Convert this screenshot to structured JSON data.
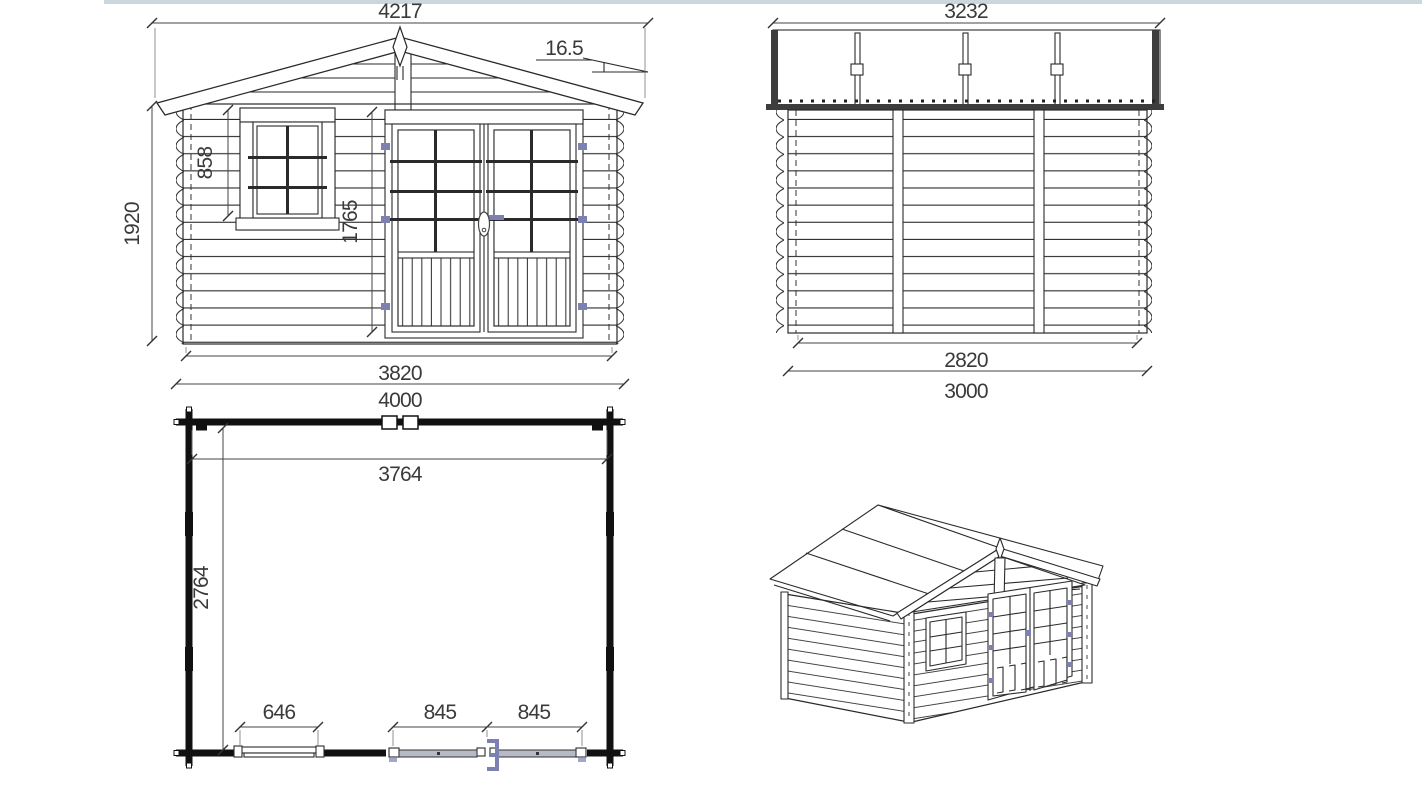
{
  "sheet": {
    "top_strip_color": "#ccd7dd",
    "background": "#ffffff"
  },
  "colors": {
    "line": "#2a2a2a",
    "accent": "#7c80b3",
    "door_slab_fill": "#b6bac5",
    "wall_dark": "#111111",
    "text": "#3a3a3a"
  },
  "views": {
    "front_elevation": {
      "label": "front elevation",
      "dims": {
        "roof_overall_width": "4217",
        "roof_pitch_deg": "16.5",
        "wall_height": "1920",
        "window_height": "858",
        "door_height": "1765",
        "wall_width": "3820",
        "overall_width": "4000"
      }
    },
    "side_elevation": {
      "label": "side elevation",
      "dims": {
        "roof_overall_depth": "3232",
        "wall_depth": "2820",
        "overall_depth": "3000"
      }
    },
    "floor_plan": {
      "label": "floor plan",
      "dims": {
        "inner_width": "3764",
        "inner_depth": "2764",
        "window_opening": "646",
        "door_leaf_left": "845",
        "door_leaf_right": "845"
      }
    },
    "perspective": {
      "label": "3d perspective view"
    }
  }
}
